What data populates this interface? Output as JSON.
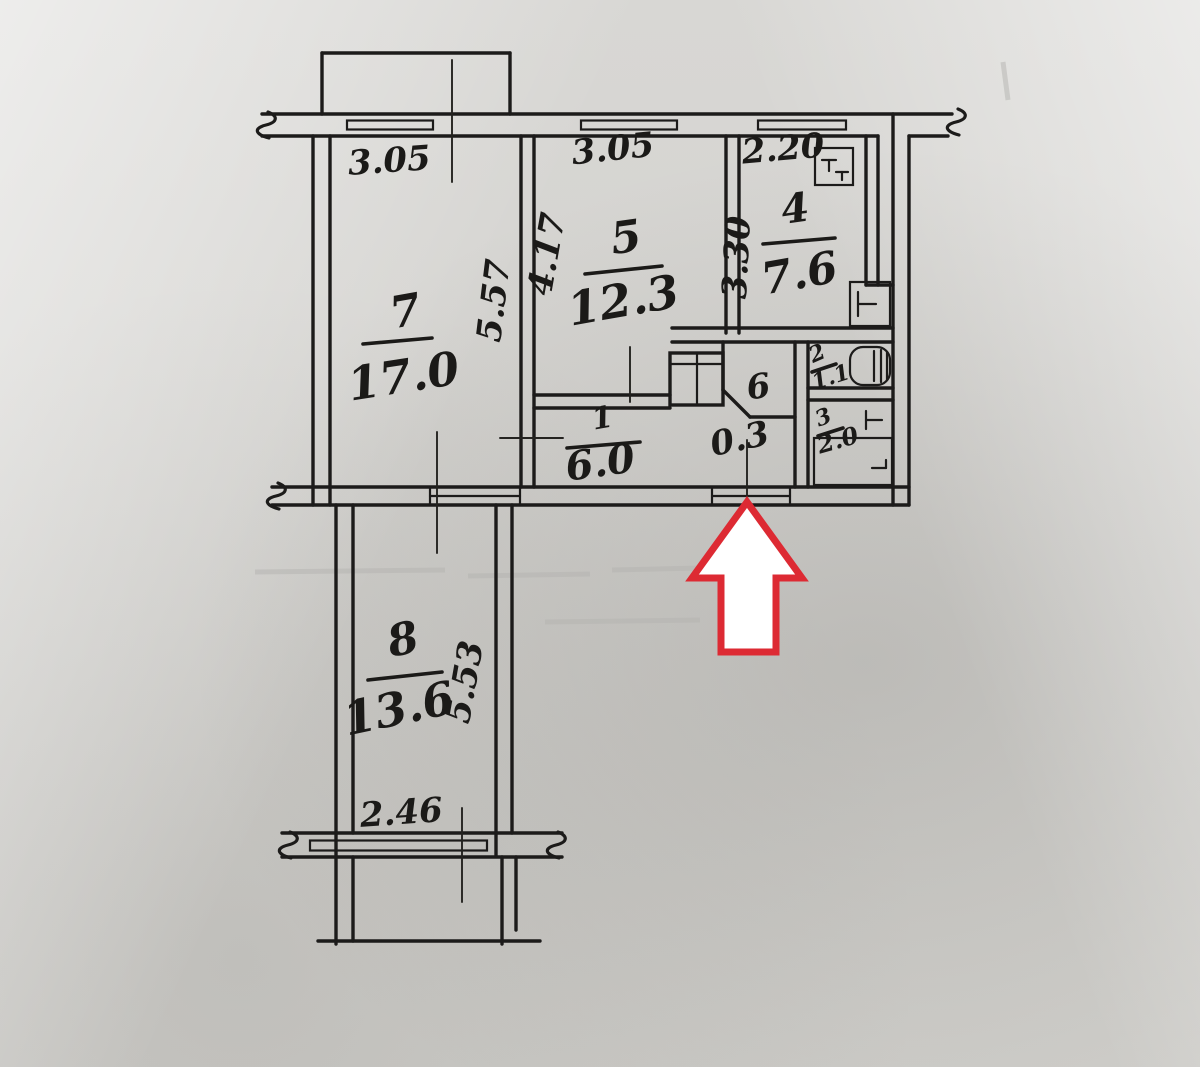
{
  "colors": {
    "paper": "#d6d5d2",
    "ink": "#1c1b1a",
    "arrow_outline": "#dd2a33",
    "arrow_fill": "#ffffff"
  },
  "plan": {
    "rooms": [
      {
        "number": "7",
        "area": "17.0"
      },
      {
        "number": "5",
        "area": "12.3"
      },
      {
        "number": "4",
        "area": "7.6"
      },
      {
        "number": "1",
        "area": "6.0"
      },
      {
        "number": "6",
        "area": "0.3"
      },
      {
        "number": "2",
        "area": "1.1"
      },
      {
        "number": "3",
        "area": "2.0"
      },
      {
        "number": "8",
        "area": "13.6"
      }
    ],
    "dimensions": {
      "room7_width": "3.05",
      "room5_width": "3.05",
      "kitchen_width": "2.20",
      "room7_depth": "5.57",
      "room5_depth": "4.17",
      "kitchen_depth": "3.30",
      "room8_depth": "5.53",
      "room8_width": "2.46"
    }
  }
}
